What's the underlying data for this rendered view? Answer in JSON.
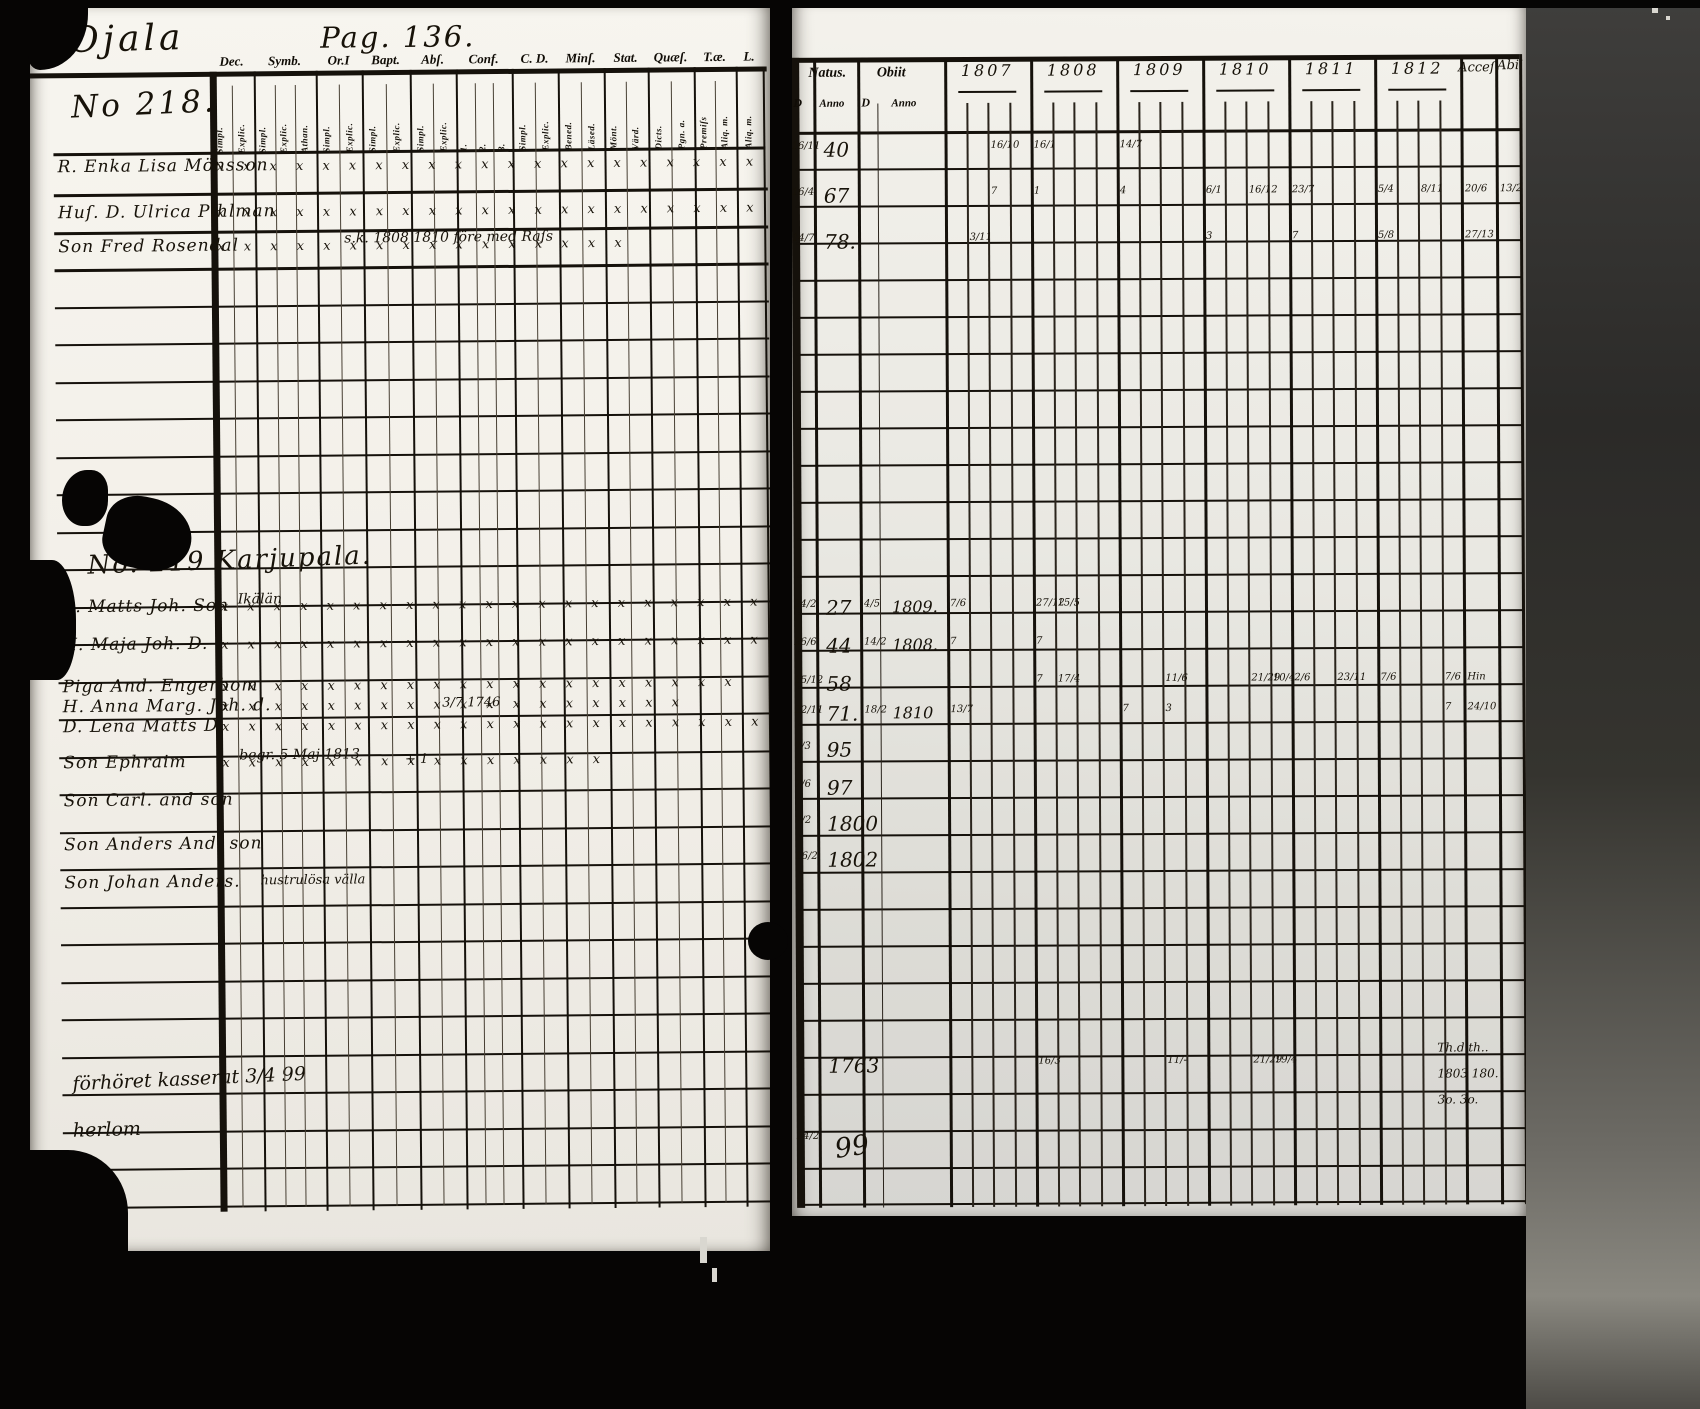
{
  "scan": {
    "place_name": "Ojala",
    "page_number": "Pag. 136.",
    "household_1": "No 218.",
    "household_2_heading": "No. 219 Karjupala."
  },
  "left_page": {
    "column_groups": [
      {
        "label": "Dec.",
        "subs": [
          "Simpl.",
          "Explic."
        ]
      },
      {
        "label": "Symb.",
        "subs": [
          "Simpl.",
          "Explic.",
          "Athan."
        ]
      },
      {
        "label": "Or.I",
        "subs": [
          "Simpl.",
          "Explic."
        ]
      },
      {
        "label": "Bapt.",
        "subs": [
          "Simpl.",
          "Explic."
        ]
      },
      {
        "label": "Abſ.",
        "subs": [
          "Simpl.",
          "Explic."
        ]
      },
      {
        "label": "Conf.",
        "subs": [
          "1.",
          "2.",
          "3."
        ]
      },
      {
        "label": "C. D.",
        "subs": [
          "Simpl.",
          "Explic."
        ]
      },
      {
        "label": "Minſ.",
        "subs": [
          "Bened.",
          "Läsed."
        ]
      },
      {
        "label": "Stat.",
        "subs": [
          "Mönt.",
          "Värd."
        ]
      },
      {
        "label": "Quæſ.",
        "subs": [
          "Dicts.",
          "Pgn. a."
        ]
      },
      {
        "label": "T.æ.",
        "subs": [
          "Premiſs",
          "Aliq. m."
        ]
      },
      {
        "label": "L.",
        "subs": [
          "Aliq. m."
        ]
      }
    ],
    "section1_rows": [
      {
        "name": "R. Enka Lisa Mönsson",
        "marks": "x x x x x x x x x x x x x x x x x x x x x x x x",
        "above": "",
        "tail": ""
      },
      {
        "name": "Huſ. D. Ulrica Pihlman",
        "marks": "x x x x x x x x x x x x x x x x x x x x x x x",
        "above": "",
        "tail": ""
      },
      {
        "name": "Son Fred Rosendal",
        "marks": "x x x x x x x x x x x x x x x x",
        "above": "s.k. 1808    1810 före med Raſs",
        "tail": ""
      }
    ],
    "section2_rows": [
      {
        "name": "B. Matts Joh. Son",
        "marks": "x x x x x x x x x x x x x x x x x x x x x x",
        "above": "Ikälän",
        "tail": ""
      },
      {
        "name": "H. Maja Joh. D.",
        "marks": "x x x x x x x x x x x x x x x x x x x x x x",
        "above": "",
        "tail": ""
      },
      {
        "name": "Piga And. Engerbom",
        "marks": "x x x x x x x x x x x x x x x x x x x x",
        "above": "",
        "tail": ""
      },
      {
        "name": "H. Anna Marg. Joh. d.",
        "marks": "x x x x x x x x x x x x x x x x x x",
        "above": "",
        "tail": "3/7 1746"
      },
      {
        "name": "D. Lena Matts D.",
        "marks": "x x x x x x x x x x x x x x x x x x x x x x",
        "above": "",
        "tail": ""
      },
      {
        "name": "Son Ephraim",
        "marks": "x x x x x x x x x x x x x x x",
        "above": "begr. 5 Maj 1813",
        "tail": "+ 1"
      },
      {
        "name": "Son Carl. and son",
        "marks": "",
        "above": "",
        "tail": ""
      },
      {
        "name": "Son Anders And. son",
        "marks": "",
        "above": "",
        "tail": ""
      },
      {
        "name": "Son Johan Anders.",
        "marks": "",
        "above": "",
        "tail": "hustrulösa välla"
      }
    ],
    "bottom_notes": [
      "förhöret  kasserat 3/4 99",
      "herlom"
    ]
  },
  "right_page": {
    "headers": {
      "natus": "Natus.",
      "obiit": "Obiit",
      "d": "D",
      "anno": "Anno",
      "years": [
        "1807",
        "1808",
        "1809",
        "1810",
        "1811",
        "1812"
      ],
      "accessit": "Acceſ.",
      "abiit": "Abii"
    },
    "rows": [
      {
        "nd": "16/11",
        "na": "40",
        "od": "",
        "oa": "",
        "accf": "",
        "abii": "",
        "cells": [
          [
            "1807",
            2,
            "16/10"
          ],
          [
            "1808",
            0,
            "16/1"
          ],
          [
            "1809",
            0,
            "14/7"
          ]
        ]
      },
      {
        "nd": "16/4",
        "na": "67",
        "od": "",
        "oa": "",
        "accf": "20/6",
        "abii": "13/2",
        "cells": [
          [
            "1807",
            2,
            "7"
          ],
          [
            "1808",
            0,
            "1"
          ],
          [
            "1809",
            0,
            "4"
          ],
          [
            "1810",
            0,
            "6/1"
          ],
          [
            "1810",
            2,
            "16/12"
          ],
          [
            "1811",
            0,
            "23/7"
          ],
          [
            "1812",
            0,
            "5/4"
          ],
          [
            "1812",
            2,
            "8/11"
          ]
        ]
      },
      {
        "nd": "14/7",
        "na": "78.",
        "od": "",
        "oa": "",
        "accf": "27/13",
        "abii": "",
        "cells": [
          [
            "1807",
            1,
            "3/11"
          ],
          [
            "1810",
            0,
            "3"
          ],
          [
            "1811",
            0,
            "7"
          ],
          [
            "1812",
            0,
            "5/8"
          ]
        ]
      },
      {
        "nd": "24/2",
        "na": "27",
        "od": "4/5",
        "oa": "1809.",
        "accf": "",
        "abii": "",
        "cells": [
          [
            "1807",
            0,
            "7/6"
          ],
          [
            "1808",
            0,
            "27/12"
          ],
          [
            "1808",
            1,
            "15/5"
          ]
        ]
      },
      {
        "nd": "26/6",
        "na": "44",
        "od": "14/2",
        "oa": "1808.",
        "accf": "",
        "abii": "",
        "cells": [
          [
            "1807",
            0,
            "7"
          ],
          [
            "1808",
            0,
            "7"
          ]
        ]
      },
      {
        "nd": "15/12",
        "na": "58",
        "od": "",
        "oa": "",
        "accf": "Hin",
        "abii": "",
        "cells": [
          [
            "1808",
            0,
            "7"
          ],
          [
            "1808",
            1,
            "17/4"
          ],
          [
            "1809",
            2,
            "11/6"
          ],
          [
            "1810",
            2,
            "21/29"
          ],
          [
            "1810",
            3,
            "10/4"
          ],
          [
            "1811",
            0,
            "2/6"
          ],
          [
            "1811",
            2,
            "23/11"
          ],
          [
            "1812",
            0,
            "7/6"
          ],
          [
            "1812",
            3,
            "7/6"
          ]
        ]
      },
      {
        "nd": "22/11",
        "na": "71.",
        "od": "18/2",
        "oa": "1810",
        "accf": "24/10",
        "abii": "",
        "cells": [
          [
            "1807",
            0,
            "13/7"
          ],
          [
            "1809",
            0,
            "7"
          ],
          [
            "1809",
            2,
            "3"
          ],
          [
            "1812",
            3,
            "7"
          ]
        ]
      },
      {
        "nd": "7/3",
        "na": "95",
        "od": "",
        "oa": "",
        "accf": "",
        "abii": "",
        "cells": []
      },
      {
        "nd": "7/6",
        "na": "97",
        "od": "",
        "oa": "",
        "accf": "",
        "abii": "",
        "cells": []
      },
      {
        "nd": "7/2",
        "na": "1800",
        "od": "",
        "oa": "",
        "accf": "",
        "abii": "",
        "cells": []
      },
      {
        "nd": "16/2",
        "na": "1802",
        "od": "",
        "oa": "",
        "accf": "",
        "abii": "",
        "cells": []
      }
    ],
    "bottom_row": {
      "nd": "",
      "na": "1763",
      "cells": [
        [
          "1808",
          0,
          "16/3"
        ],
        [
          "1809",
          2,
          "11/-"
        ],
        [
          "1810",
          2,
          "21/29"
        ],
        [
          "1810",
          3,
          "19/4"
        ]
      ]
    },
    "bottom_total": {
      "d": "24/2",
      "value": "99"
    },
    "margin_notes": [
      "Th.d th..",
      "1803 180.",
      "3o.  3o."
    ]
  }
}
